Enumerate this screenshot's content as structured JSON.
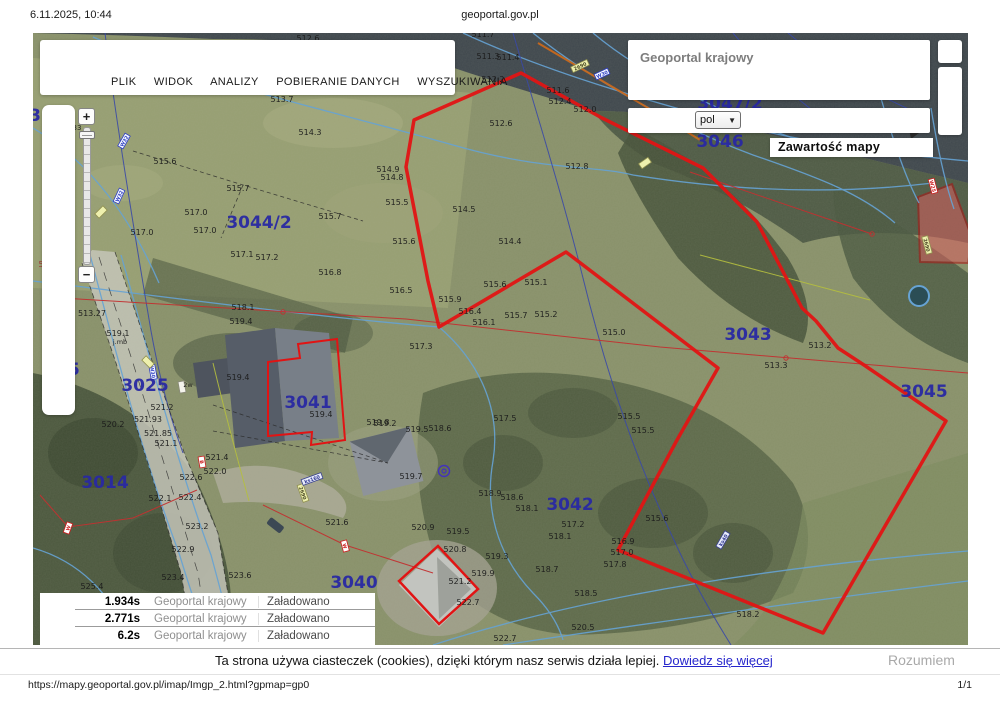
{
  "header": {
    "datetime": "6.11.2025, 10:44",
    "site": "geoportal.gov.pl"
  },
  "footer": {
    "url": "https://mapy.geoportal.gov.pl/imap/Imgp_2.html?gpmap=gp0",
    "page": "1/1"
  },
  "menu": {
    "items": [
      "PLIK",
      "WIDOK",
      "ANALIZY",
      "POBIERANIE DANYCH",
      "WYSZUKIWANIA"
    ]
  },
  "panel": {
    "title": "Geoportal krajowy",
    "language_value": "pol",
    "map_contents_label": "Zawartość mapy"
  },
  "zoom_controls": {
    "zoom_in": "+",
    "zoom_out": "−"
  },
  "loading_log": {
    "rows": [
      {
        "time": "1.934s",
        "layer": "Geoportal krajowy",
        "status": "Załadowano"
      },
      {
        "time": "2.771s",
        "layer": "Geoportal krajowy",
        "status": "Załadowano"
      },
      {
        "time": "6.2s",
        "layer": "Geoportal krajowy",
        "status": "Załadowano"
      }
    ]
  },
  "cookie_banner": {
    "message": "Ta strona używa ciasteczek (cookies), dzięki którym nasz serwis działa lepiej. ",
    "link": "Dowiedz się więcej",
    "accept_label": "Rozumiem"
  },
  "map": {
    "colors": {
      "boundary_red": "#e11414",
      "thin_red": "#c23030",
      "parcel_label": "#2929a3",
      "water_line": "#66a3d4",
      "utility_navy": "#3a49a6",
      "power_orange": "#c8681c",
      "elevation_label": "#1b1b1b"
    },
    "parcel_labels": [
      {
        "text": "3044/2",
        "x": 226,
        "y": 195
      },
      {
        "text": "3047/2",
        "x": 697,
        "y": 76
      },
      {
        "text": "3046",
        "x": 687,
        "y": 114
      },
      {
        "text": "3043",
        "x": 715,
        "y": 307
      },
      {
        "text": "3045",
        "x": 891,
        "y": 364
      },
      {
        "text": "3042",
        "x": 537,
        "y": 477
      },
      {
        "text": "3041",
        "x": 275,
        "y": 375
      },
      {
        "text": "3040",
        "x": 321,
        "y": 555
      },
      {
        "text": "3025",
        "x": 112,
        "y": 358
      },
      {
        "text": "3014",
        "x": 72,
        "y": 455
      },
      {
        "text": "05",
        "x": 35,
        "y": 342
      },
      {
        "text": "3",
        "x": 2,
        "y": 88
      }
    ],
    "elevation_labels": [
      {
        "text": "512.6",
        "x": 275,
        "y": 8
      },
      {
        "text": "511.7",
        "x": 450,
        "y": 4
      },
      {
        "text": "511.3",
        "x": 455,
        "y": 26
      },
      {
        "text": "511.4",
        "x": 475,
        "y": 27
      },
      {
        "text": "512.2",
        "x": 460,
        "y": 49
      },
      {
        "text": "511.6",
        "x": 525,
        "y": 60
      },
      {
        "text": "512.4",
        "x": 527,
        "y": 71
      },
      {
        "text": "512.0",
        "x": 552,
        "y": 79
      },
      {
        "text": "512.6",
        "x": 468,
        "y": 93
      },
      {
        "text": "512.8",
        "x": 544,
        "y": 136
      },
      {
        "text": "513.7",
        "x": 249,
        "y": 69
      },
      {
        "text": "514.3",
        "x": 277,
        "y": 102
      },
      {
        "text": "515.6",
        "x": 132,
        "y": 131
      },
      {
        "text": "515.7",
        "x": 205,
        "y": 158
      },
      {
        "text": "517.0",
        "x": 163,
        "y": 182
      },
      {
        "text": "517.0",
        "x": 172,
        "y": 200
      },
      {
        "text": "517.0",
        "x": 109,
        "y": 202
      },
      {
        "text": "515.7",
        "x": 297,
        "y": 186
      },
      {
        "text": "514.9",
        "x": 355,
        "y": 139
      },
      {
        "text": "514.8",
        "x": 359,
        "y": 147
      },
      {
        "text": "515.5",
        "x": 364,
        "y": 172
      },
      {
        "text": "515.6",
        "x": 371,
        "y": 211
      },
      {
        "text": "517.1",
        "x": 209,
        "y": 224
      },
      {
        "text": "517.2",
        "x": 234,
        "y": 227
      },
      {
        "text": "516.8",
        "x": 297,
        "y": 242
      },
      {
        "text": "516.5",
        "x": 368,
        "y": 260
      },
      {
        "text": "518.1",
        "x": 210,
        "y": 277
      },
      {
        "text": "514.5",
        "x": 431,
        "y": 179
      },
      {
        "text": "514.4",
        "x": 477,
        "y": 211
      },
      {
        "text": "515.9",
        "x": 417,
        "y": 269
      },
      {
        "text": "516.4",
        "x": 437,
        "y": 281
      },
      {
        "text": "515.6",
        "x": 462,
        "y": 254
      },
      {
        "text": "515.1",
        "x": 503,
        "y": 252
      },
      {
        "text": "515.7",
        "x": 483,
        "y": 285
      },
      {
        "text": "515.2",
        "x": 513,
        "y": 284
      },
      {
        "text": "516.1",
        "x": 451,
        "y": 292
      },
      {
        "text": "515.0",
        "x": 581,
        "y": 302
      },
      {
        "text": "517.3",
        "x": 388,
        "y": 316
      },
      {
        "text": "517.5",
        "x": 472,
        "y": 388
      },
      {
        "text": "515.5",
        "x": 596,
        "y": 386
      },
      {
        "text": "515.5",
        "x": 610,
        "y": 400
      },
      {
        "text": "519.5",
        "x": 384,
        "y": 399
      },
      {
        "text": "518.6",
        "x": 407,
        "y": 398
      },
      {
        "text": "519.2",
        "x": 352,
        "y": 393
      },
      {
        "text": "519.7",
        "x": 378,
        "y": 446
      },
      {
        "text": "518.9",
        "x": 457,
        "y": 463
      },
      {
        "text": "518.6",
        "x": 479,
        "y": 467
      },
      {
        "text": "518.1",
        "x": 494,
        "y": 478
      },
      {
        "text": "517.2",
        "x": 540,
        "y": 494
      },
      {
        "text": "518.1",
        "x": 527,
        "y": 506
      },
      {
        "text": "516.9",
        "x": 590,
        "y": 511
      },
      {
        "text": "517.0",
        "x": 589,
        "y": 522
      },
      {
        "text": "517.8",
        "x": 582,
        "y": 534
      },
      {
        "text": "518.7",
        "x": 514,
        "y": 539
      },
      {
        "text": "519.3",
        "x": 464,
        "y": 526
      },
      {
        "text": "519.9",
        "x": 450,
        "y": 543
      },
      {
        "text": "521.2",
        "x": 427,
        "y": 551
      },
      {
        "text": "522.7",
        "x": 435,
        "y": 572
      },
      {
        "text": "520.9",
        "x": 390,
        "y": 497
      },
      {
        "text": "520.8",
        "x": 422,
        "y": 519
      },
      {
        "text": "519.5",
        "x": 425,
        "y": 501
      },
      {
        "text": "521.6",
        "x": 304,
        "y": 492
      },
      {
        "text": "518.5",
        "x": 553,
        "y": 563
      },
      {
        "text": "520.5",
        "x": 550,
        "y": 597
      },
      {
        "text": "515.6",
        "x": 624,
        "y": 488
      },
      {
        "text": "518.2",
        "x": 715,
        "y": 584
      },
      {
        "text": "513.3",
        "x": 743,
        "y": 335
      },
      {
        "text": "513.2",
        "x": 787,
        "y": 315
      },
      {
        "text": "513.27",
        "x": 59,
        "y": 283
      },
      {
        "text": "519.1",
        "x": 85,
        "y": 303
      },
      {
        "text": "519.4",
        "x": 208,
        "y": 291
      },
      {
        "text": "519.4",
        "x": 205,
        "y": 347
      },
      {
        "text": "519.4",
        "x": 288,
        "y": 384
      },
      {
        "text": "519.8",
        "x": 345,
        "y": 392
      },
      {
        "text": "521.2",
        "x": 129,
        "y": 377
      },
      {
        "text": "521.93",
        "x": 115,
        "y": 389
      },
      {
        "text": "521.85",
        "x": 125,
        "y": 403
      },
      {
        "text": "521.1",
        "x": 133,
        "y": 413
      },
      {
        "text": "520.2",
        "x": 80,
        "y": 394
      },
      {
        "text": "522.0",
        "x": 182,
        "y": 441
      },
      {
        "text": "521.4",
        "x": 184,
        "y": 427
      },
      {
        "text": "522.6",
        "x": 158,
        "y": 447
      },
      {
        "text": "522.4",
        "x": 157,
        "y": 467
      },
      {
        "text": "522.1",
        "x": 127,
        "y": 468
      },
      {
        "text": "523.2",
        "x": 164,
        "y": 496
      },
      {
        "text": "522.9",
        "x": 150,
        "y": 519
      },
      {
        "text": "523.6",
        "x": 207,
        "y": 545
      },
      {
        "text": "523.4",
        "x": 140,
        "y": 547
      },
      {
        "text": "525.4",
        "x": 59,
        "y": 556
      },
      {
        "text": "522.7",
        "x": 472,
        "y": 608
      },
      {
        "text": "518.3",
        "x": 17,
        "y": 234,
        "c": "#a33434"
      },
      {
        "text": "33",
        "x": 44,
        "y": 97,
        "s": 7
      },
      {
        "text": "56",
        "x": 30,
        "y": 134,
        "s": 7
      },
      {
        "text": "50",
        "x": 32,
        "y": 140,
        "s": 7
      },
      {
        "text": "j.mb",
        "x": 87,
        "y": 311,
        "s": 6.5
      },
      {
        "text": "2w",
        "x": 155,
        "y": 354,
        "s": 6.5
      }
    ],
    "sign_labels": [
      {
        "text": "W32",
        "x": 91,
        "y": 108,
        "rot": -60,
        "type": "blue"
      },
      {
        "text": "W32",
        "x": 86,
        "y": 163,
        "rot": -65,
        "type": "blue"
      },
      {
        "text": "W30",
        "x": 569,
        "y": 41,
        "rot": -25,
        "type": "blue"
      },
      {
        "text": "W30",
        "x": 120,
        "y": 339,
        "rot": 80,
        "type": "blue"
      },
      {
        "text": "2690",
        "x": 547,
        "y": 33,
        "rot": -25,
        "type": "yellow"
      },
      {
        "text": "",
        "x": 612,
        "y": 130,
        "rot": -35,
        "type": "yellow"
      },
      {
        "text": "2690",
        "x": 894,
        "y": 212,
        "rot": 75,
        "type": "yellow"
      },
      {
        "text": "2690",
        "x": 270,
        "y": 460,
        "rot": 70,
        "type": "yellow"
      },
      {
        "text": "",
        "x": 115,
        "y": 329,
        "rot": 45,
        "type": "yellow"
      },
      {
        "text": "",
        "x": 68,
        "y": 179,
        "rot": -45,
        "type": "yellow"
      },
      {
        "text": "",
        "x": 149,
        "y": 354,
        "rot": 80,
        "type": "white"
      },
      {
        "text": "W",
        "x": 35,
        "y": 495,
        "rot": -70,
        "type": "red"
      },
      {
        "text": "W",
        "x": 312,
        "y": 513,
        "rot": 75,
        "type": "red"
      },
      {
        "text": "W25",
        "x": 900,
        "y": 153,
        "rot": 75,
        "type": "red"
      },
      {
        "text": "B",
        "x": 169,
        "y": 429,
        "rot": 80,
        "type": "red"
      },
      {
        "text": "ks160",
        "x": 279,
        "y": 446,
        "rot": -20,
        "type": "navy"
      },
      {
        "text": "ks40",
        "x": 690,
        "y": 507,
        "rot": -60,
        "type": "navy"
      }
    ]
  }
}
